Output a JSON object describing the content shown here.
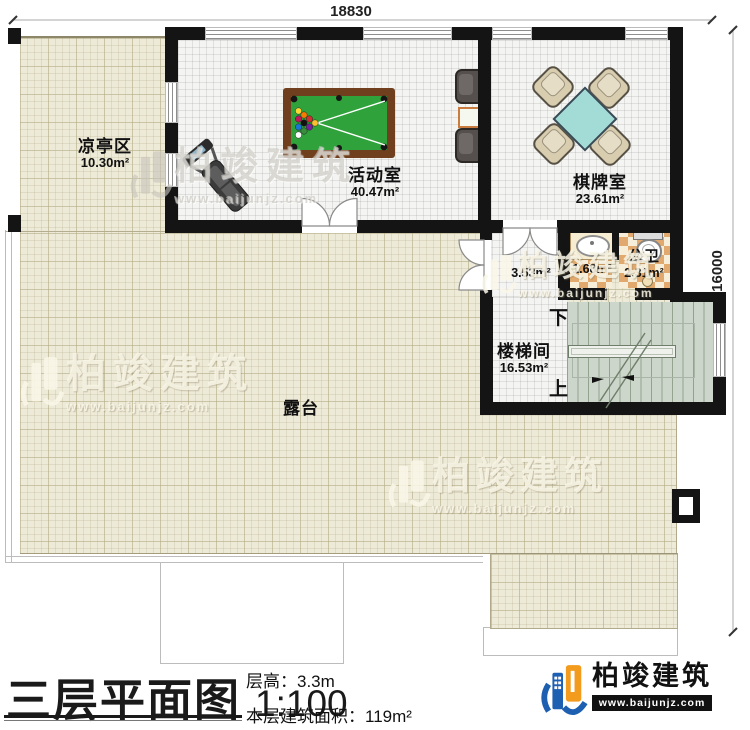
{
  "title_block": {
    "title": "三层平面图",
    "scale": "1:100",
    "floor_height_label": "层高：",
    "floor_height_value": "3.3m",
    "floor_area_label": "本层建筑面积：",
    "floor_area_value": "119m²"
  },
  "brand": {
    "name": "柏竣建筑",
    "site": "www.baijunjz.com"
  },
  "watermark": {
    "name": "柏竣建筑",
    "site": "www.baijunjz.com"
  },
  "dimensions": {
    "top": "18830",
    "right": "16000"
  },
  "rooms": [
    {
      "id": "pavilion",
      "name": "凉亭区",
      "area": "10.30m²"
    },
    {
      "id": "activity",
      "name": "活动室",
      "area": "40.47m²"
    },
    {
      "id": "chess",
      "name": "棋牌室",
      "area": "23.61m²"
    },
    {
      "id": "wash",
      "name": "",
      "area": "1.68m²"
    },
    {
      "id": "bath",
      "name": "公卫",
      "area": "2.31m²"
    },
    {
      "id": "hall",
      "name": "",
      "area": "3.53m²"
    },
    {
      "id": "stair",
      "name": "楼梯间",
      "area": "16.53m²"
    },
    {
      "id": "terrace",
      "name": "露台",
      "area": ""
    }
  ],
  "stairs": {
    "down": "下",
    "up": "上"
  }
}
